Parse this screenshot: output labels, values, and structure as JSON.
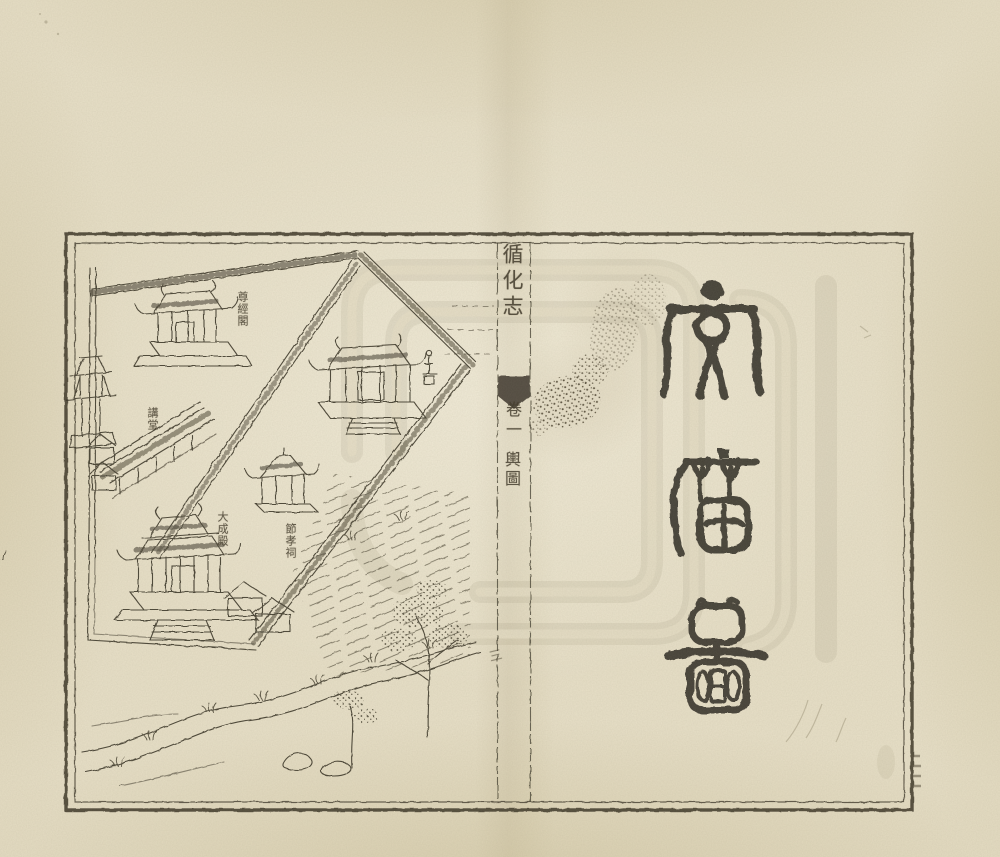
{
  "spine": {
    "book_title": "循化志",
    "volume": "卷一",
    "section": "輿圖",
    "page_number": "三"
  },
  "right_page": {
    "title": "文廟圖",
    "chars": [
      "文",
      "廟",
      "圖"
    ]
  },
  "illustration": {
    "labels": [
      {
        "text": "尊經閣"
      },
      {
        "text": "講堂"
      },
      {
        "text": "大成殿"
      },
      {
        "text": "節孝祠"
      }
    ]
  },
  "colors": {
    "paper": "#e8e0c8",
    "ink": "#3e382b",
    "seal_ink": "#35302a",
    "stain": "#6d5c3c",
    "watermark": "#7c745a"
  }
}
